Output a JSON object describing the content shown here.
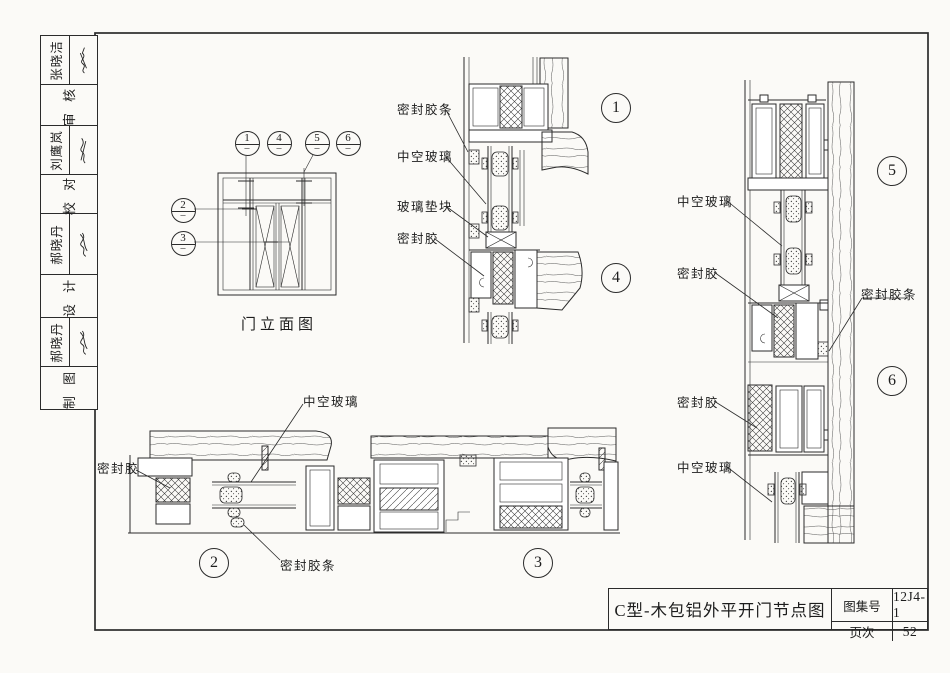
{
  "colors": {
    "ink": "#2b2b2b",
    "paper": "#fbfaf7"
  },
  "sidebar": {
    "rows": [
      {
        "name": "张晓洁"
      },
      {
        "label": "审 核"
      },
      {
        "name": "刘鹰岚"
      },
      {
        "label": "校 对"
      },
      {
        "name": "郝晓丹"
      },
      {
        "label": "设 计"
      },
      {
        "name": "郝晓丹"
      },
      {
        "label": "制 图"
      }
    ]
  },
  "elevation": {
    "caption": "门立面图",
    "callout_sub": "–"
  },
  "callouts": {
    "c1": "1",
    "c2": "2",
    "c3": "3",
    "c4": "4",
    "c5": "5",
    "c6": "6"
  },
  "labels": {
    "seal_strip": "密封胶条",
    "insulating_glass": "中空玻璃",
    "glass_block": "玻璃垫块",
    "sealant": "密封胶"
  },
  "title_block": {
    "title": "C型-木包铝外平开门节点图",
    "atlas_label": "图集号",
    "atlas_no": "12J4-1",
    "page_label": "页次",
    "page_no": "52"
  }
}
